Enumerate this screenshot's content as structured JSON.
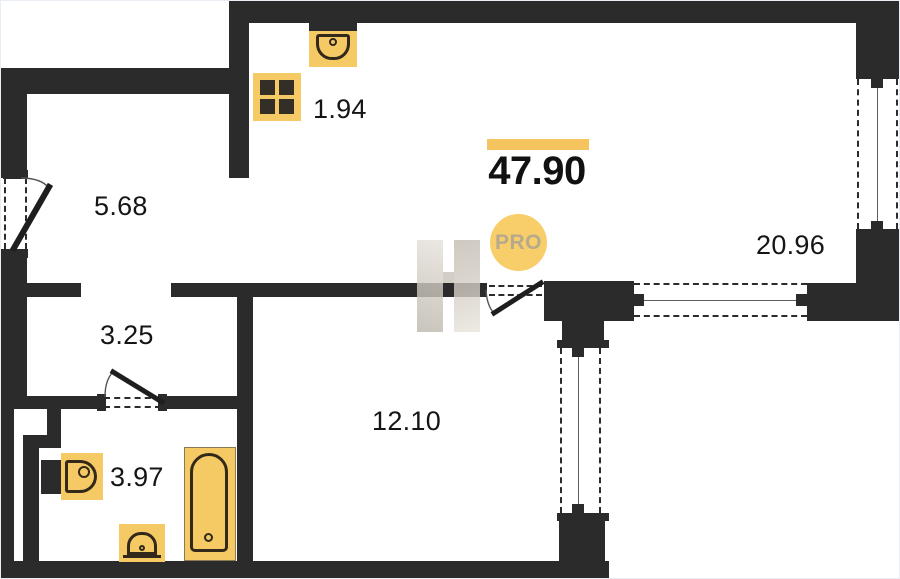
{
  "plan": {
    "total_area": "47.90",
    "badge": "PRO",
    "rooms": [
      {
        "id": "kitchen-niche",
        "area": "1.94"
      },
      {
        "id": "hallway",
        "area": "5.68"
      },
      {
        "id": "corridor",
        "area": "3.25"
      },
      {
        "id": "bathroom",
        "area": "3.97"
      },
      {
        "id": "bedroom",
        "area": "12.10"
      },
      {
        "id": "living-room",
        "area": "20.96"
      }
    ],
    "icons": [
      "stove-icon",
      "kitchen-sink-icon",
      "toilet-icon",
      "washbasin-icon",
      "bathtub-icon",
      "logo-watermark"
    ],
    "colors": {
      "wall": "#2B2B2B",
      "accent_bar": "#F6C45E",
      "fixture_fill": "#F5C963",
      "fixture_outline": "#33291B",
      "badge_bg": "#F8CE6B",
      "badge_text": "#B6A98C",
      "watermark": "#D5CFC5"
    }
  }
}
